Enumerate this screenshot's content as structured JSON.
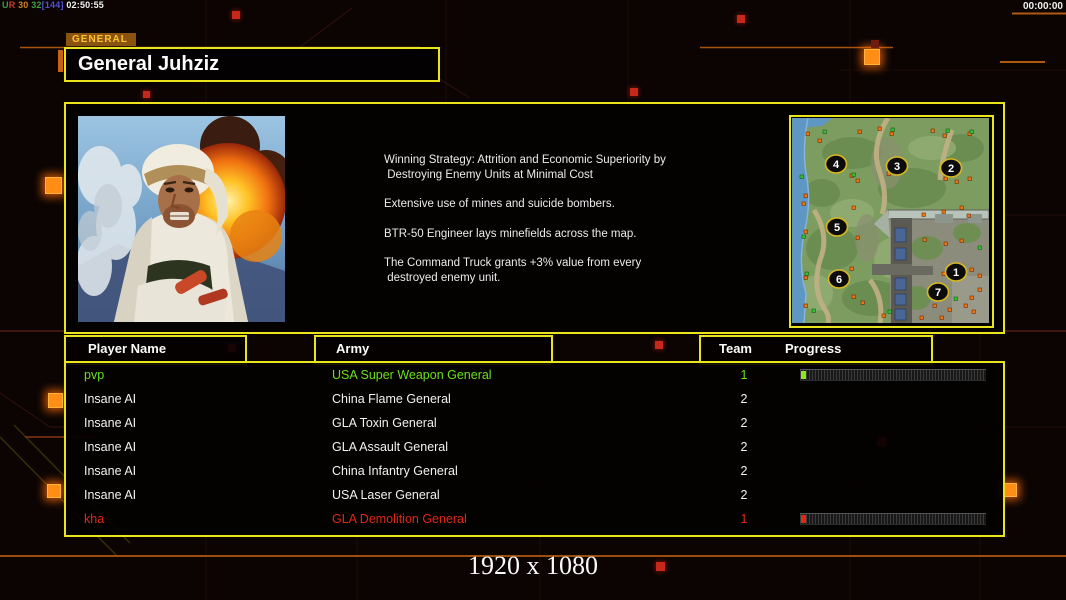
{
  "overlay": {
    "net_stats": [
      {
        "text": "U",
        "color": "#3f9e3f"
      },
      {
        "text": "R",
        "color": "#cc3a20"
      },
      {
        "text": " 30 ",
        "color": "#d08422"
      },
      {
        "text": "32",
        "color": "#3f9e3f"
      },
      {
        "text": "[144]",
        "color": "#5252cc"
      },
      {
        "text": " 02:50:55",
        "color": "#f2f2f2"
      }
    ],
    "timer": "00:00:00",
    "resolution": "1920 x 1080"
  },
  "general": {
    "tab_label": "GENERAL",
    "name": "General Juhziz",
    "strategy": [
      [
        "Winning Strategy: Attrition and Economic Superiority by",
        " Destroying Enemy Units at Minimal Cost"
      ],
      [
        "Extensive use of mines and suicide bombers."
      ],
      [
        "BTR-50 Engineer lays minefields across the map."
      ],
      [
        "The Command Truck grants +3% value from every",
        " destroyed enemy unit."
      ]
    ]
  },
  "minimap": {
    "markers": [
      {
        "n": "1",
        "x": 164,
        "y": 154
      },
      {
        "n": "2",
        "x": 159,
        "y": 50
      },
      {
        "n": "3",
        "x": 105,
        "y": 48
      },
      {
        "n": "4",
        "x": 44,
        "y": 46
      },
      {
        "n": "5",
        "x": 45,
        "y": 109
      },
      {
        "n": "6",
        "x": 47,
        "y": 161
      },
      {
        "n": "7",
        "x": 146,
        "y": 174
      }
    ]
  },
  "table": {
    "headers": {
      "player": "Player Name",
      "army": "Army",
      "team": "Team",
      "progress": "Progress"
    },
    "rows": [
      {
        "player": "pvp",
        "army": "USA Super Weapon General",
        "team": "1",
        "color": "#6ae019",
        "bar": "#8ee61e"
      },
      {
        "player": "Insane AI",
        "army": "China Flame General",
        "team": "2",
        "color": "#f2f2f2",
        "bar": null
      },
      {
        "player": "Insane AI",
        "army": "GLA Toxin General",
        "team": "2",
        "color": "#f2f2f2",
        "bar": null
      },
      {
        "player": "Insane AI",
        "army": "GLA Assault General",
        "team": "2",
        "color": "#f2f2f2",
        "bar": null
      },
      {
        "player": "Insane AI",
        "army": "China Infantry General",
        "team": "2",
        "color": "#f2f2f2",
        "bar": null
      },
      {
        "player": "Insane AI",
        "army": "USA Laser General",
        "team": "2",
        "color": "#f2f2f2",
        "bar": null
      },
      {
        "player": "kha",
        "army": "GLA Demolition General",
        "team": "1",
        "color": "#e02815",
        "bar": "#e02818"
      }
    ]
  }
}
